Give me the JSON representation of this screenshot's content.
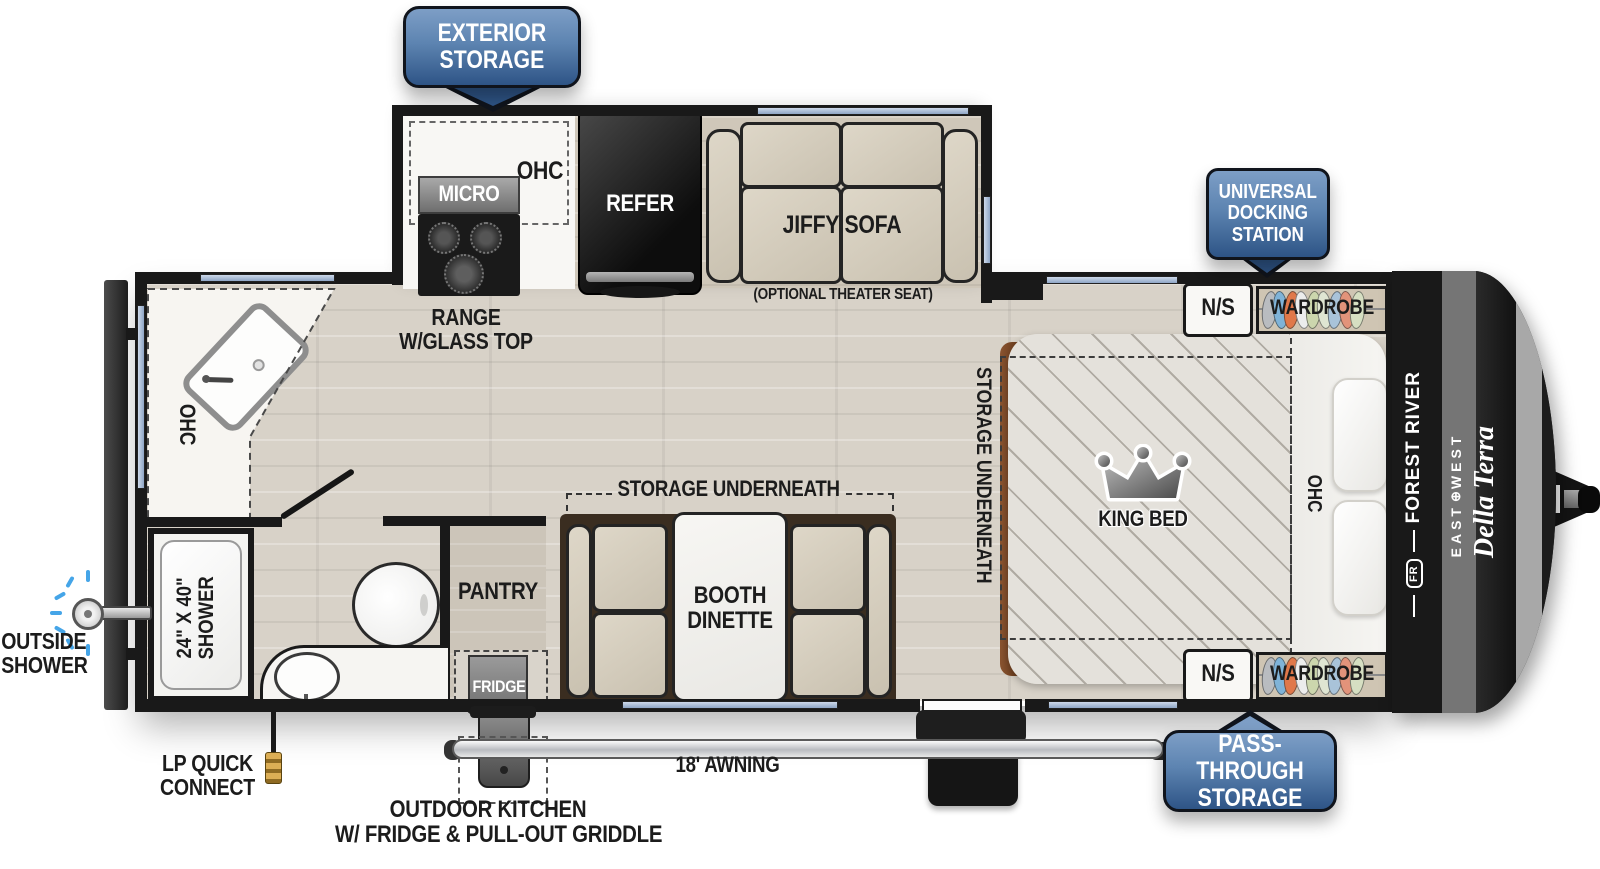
{
  "callouts": {
    "exterior_storage": {
      "line1": "EXTERIOR",
      "line2": "STORAGE"
    },
    "universal_docking_station": {
      "line1": "UNIVERSAL",
      "line2": "DOCKING",
      "line3": "STATION"
    },
    "pass_through_storage": {
      "line1": "PASS-THROUGH",
      "line2": "STORAGE"
    }
  },
  "galley": {
    "ohc": "OHC",
    "micro": "MICRO",
    "range_line1": "RANGE",
    "range_line2": "W/GLASS TOP",
    "refer": "REFER",
    "sofa": "JIFFY SOFA",
    "sofa_note": "(OPTIONAL THEATER SEAT)"
  },
  "bathroom": {
    "ohc": "OHC",
    "shower_line1": "24\" X 40\"",
    "shower_line2": "SHOWER"
  },
  "storage_areas": {
    "pantry": "PANTRY",
    "fridge": "FRIDGE"
  },
  "dinette": {
    "storage_label": "STORAGE UNDERNEATH",
    "label_line1": "BOOTH",
    "label_line2": "DINETTE"
  },
  "bedroom": {
    "king_bed": "KING BED",
    "storage_label": "STORAGE UNDERNEATH",
    "ohc": "OHC",
    "ns_top": "N/S",
    "ns_bottom": "N/S",
    "wardrobe_top": "WARDROBE",
    "wardrobe_bottom": "WARDROBE"
  },
  "exterior": {
    "outside_shower_line1": "OUTSIDE",
    "outside_shower_line2": "SHOWER",
    "lp_line1": "LP QUICK",
    "lp_line2": "CONNECT",
    "outdoor_kitchen_line1": "OUTDOOR KITCHEN",
    "outdoor_kitchen_line2": "W/ FRIDGE & PULL-OUT GRIDDLE",
    "awning": "18' AWNING"
  },
  "brand": {
    "forest_river": "FOREST RIVER",
    "fr_monogram": "FR",
    "east": "EAST",
    "west": "WEST",
    "model": "Della Terra"
  },
  "colors": {
    "badge_blue_top": "#7d9ec6",
    "badge_blue_bottom": "#2e5486",
    "window_blue": "#a9bdd9",
    "wall_black": "#191919",
    "floor_wood": "#d8d2c8",
    "bed_frame_brown": "#7d4a28"
  }
}
